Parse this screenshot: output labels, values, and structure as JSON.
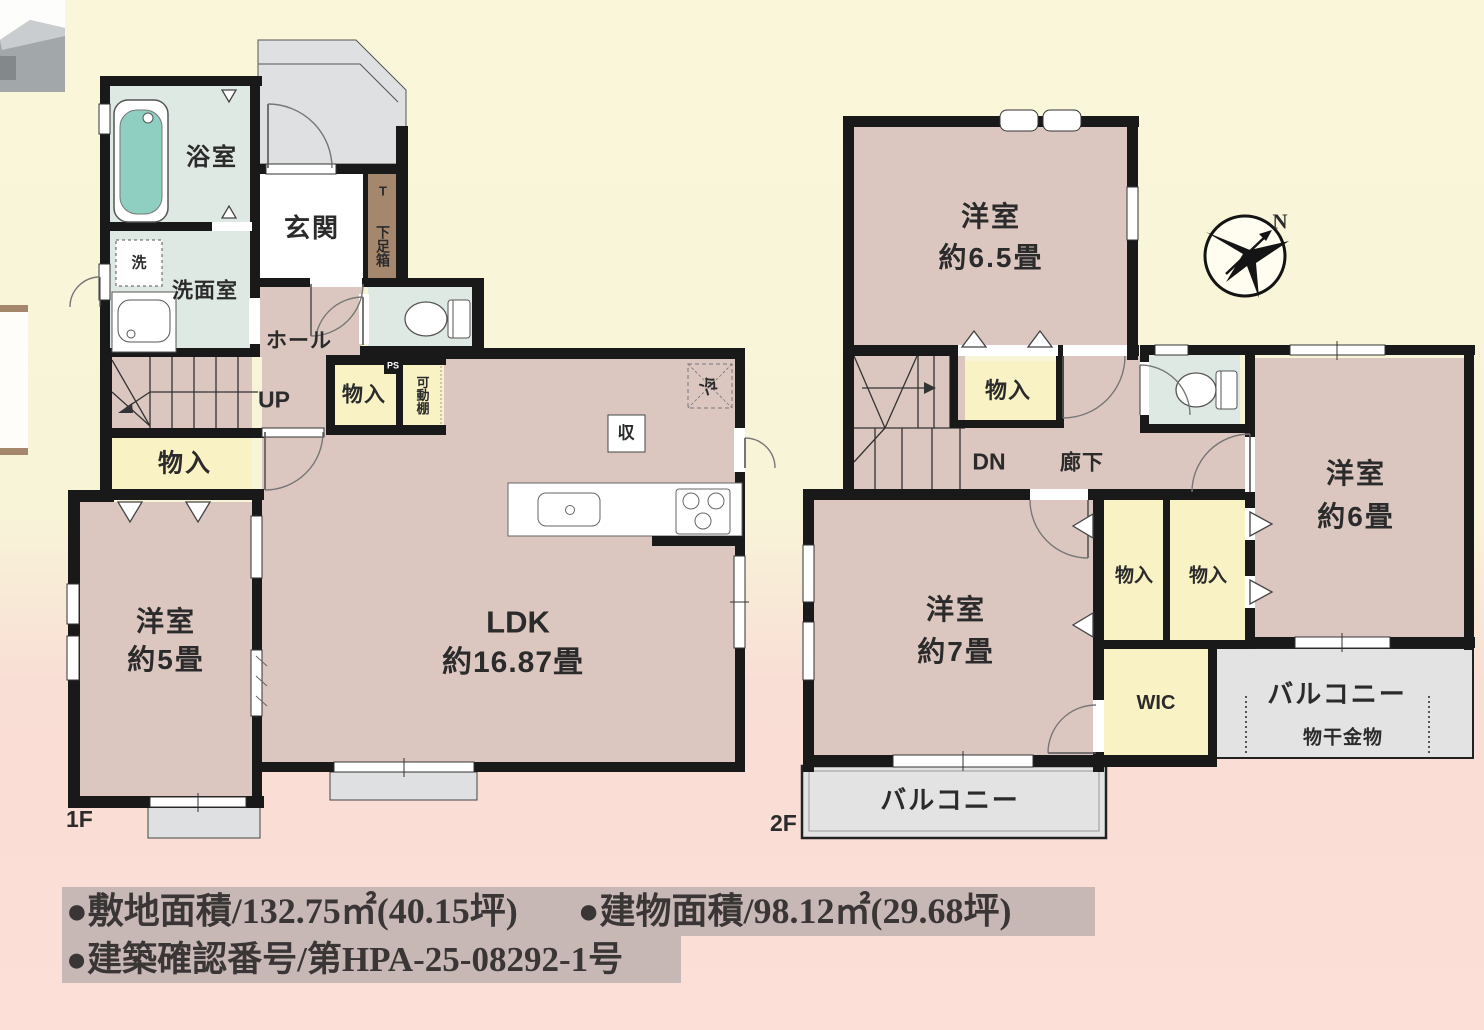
{
  "floor1": {
    "label": "1F",
    "rooms": {
      "bath": "浴室",
      "entrance": "玄関",
      "shoe_t": "T",
      "shoe_cabinet": "下足箱",
      "washer": "洗",
      "washroom": "洗面室",
      "hall": "ホール",
      "up": "UP",
      "closet_hall": "物入",
      "ps": "PS",
      "movable_shelf": "可動棚",
      "closet_stairs": "物入",
      "west_room_name": "洋室",
      "west_room_size": "約5畳",
      "ldk_name": "LDK",
      "ldk_size": "約16.87畳",
      "storage": "収",
      "fridge": "冷"
    }
  },
  "floor2": {
    "label": "2F",
    "rooms": {
      "west65_name": "洋室",
      "west65_size": "約6.5畳",
      "closet_top": "物入",
      "dn": "DN",
      "corridor": "廊下",
      "west6_name": "洋室",
      "west6_size": "約6畳",
      "closet_a": "物入",
      "closet_b": "物入",
      "west7_name": "洋室",
      "west7_size": "約7畳",
      "wic": "WIC",
      "balcony_right": "バルコニー",
      "hanging_hardware": "物干金物",
      "balcony_bottom": "バルコニー"
    }
  },
  "compass": {
    "north": "N"
  },
  "footer": {
    "site_area": "●敷地面積/132.75㎡(40.15坪)",
    "building_area": "●建物面積/98.12㎡(29.68坪)",
    "confirmation": "●建築確認番号/第HPA-25-08292-1号"
  },
  "colors": {
    "wall": "#191919",
    "room_pink": "#dcc7c0",
    "closet_yellow": "#f9f2c5",
    "wet_green": "#dfe9e3",
    "porch_gray": "#dee0e1",
    "shoe_brown": "#a5876d",
    "tub_teal": "#8fcfc2",
    "footer_band": "#c7b7b5"
  }
}
